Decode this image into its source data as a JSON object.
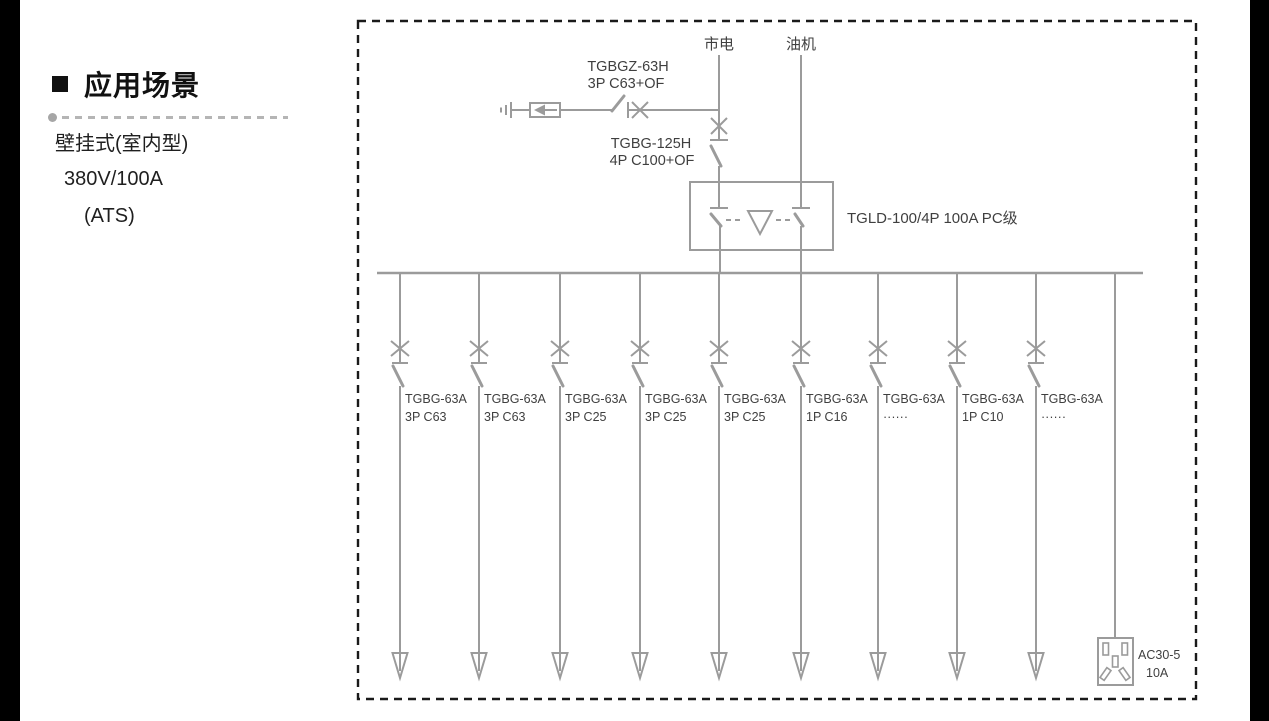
{
  "left_panel": {
    "heading": "应用场景",
    "lines": [
      "壁挂式(室内型)",
      "380V/100A",
      "(ATS)"
    ]
  },
  "diagram": {
    "source_mains": "市电",
    "source_generator": "油机",
    "spd_breaker_model": "TGBGZ-63H",
    "spd_breaker_spec": "3P C63+OF",
    "main_breaker_model": "TGBG-125H",
    "main_breaker_spec": "4P C100+OF",
    "ats_label": "TGLD-100/4P 100A PC级",
    "branches": [
      {
        "model": "TGBG-63A",
        "spec": "3P C63"
      },
      {
        "model": "TGBG-63A",
        "spec": "3P C63"
      },
      {
        "model": "TGBG-63A",
        "spec": "3P C25"
      },
      {
        "model": "TGBG-63A",
        "spec": "3P C25"
      },
      {
        "model": "TGBG-63A",
        "spec": "3P C25"
      },
      {
        "model": "TGBG-63A",
        "spec": "1P C16"
      },
      {
        "model": "TGBG-63A",
        "spec": "······"
      },
      {
        "model": "TGBG-63A",
        "spec": "1P C10"
      },
      {
        "model": "TGBG-63A",
        "spec": "······"
      }
    ],
    "socket_model": "AC30-5",
    "socket_rating": "10A",
    "colors": {
      "line": "#9b9b9b",
      "text": "#3f3f3f",
      "border": "#1a1a1a"
    }
  }
}
